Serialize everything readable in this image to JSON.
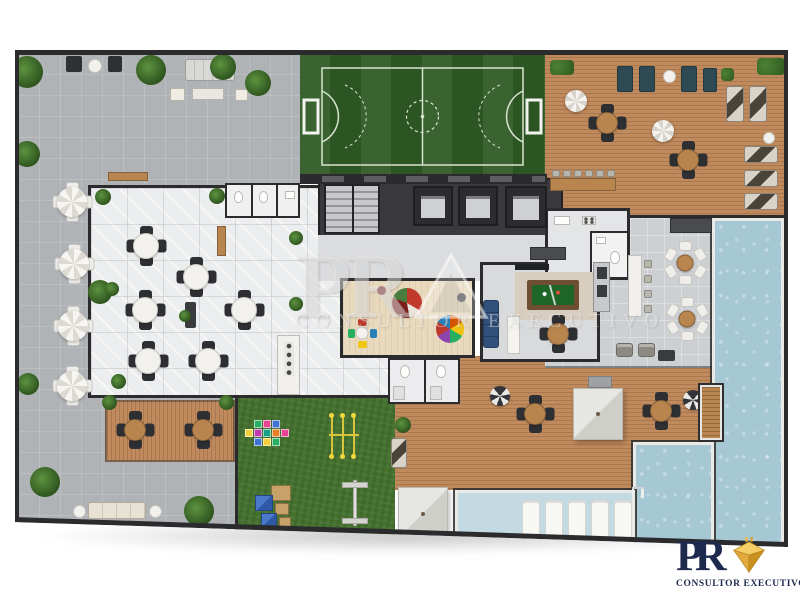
{
  "watermark": {
    "initials": "PR",
    "tagline": "CONSULTOR EXECUTIVO"
  },
  "brand": {
    "initials": "PR",
    "tagline": "CONSULTOR EXECUTIVO"
  },
  "palette": {
    "wall": "#2b2b2d",
    "terrace": "#b0b3b6",
    "hallFloor": "#ecedee",
    "poolsideTile": "#cdd0d2",
    "wood": "#c18a5c",
    "lawn": "#45722f",
    "field": "#2f5b26",
    "fieldLine": "#d8e4d0",
    "water": "#a6c7d4",
    "waterLight": "#c3dae2",
    "coping": "#e9e9e6",
    "corridor": "#dbdcde",
    "core": "#3a3a3c",
    "kidsFloor": "#e9d9bd",
    "gameFloor": "#d9dadb",
    "rug": "#d8cec0",
    "felt": "#1e652a",
    "sofaBlue": "#31517c",
    "furnWood": "#b9854f",
    "navy": "#1d2a4e",
    "gold": "#eab944"
  },
  "areas": [
    {
      "id": "paved-terrace",
      "color": "#b0b3b6"
    },
    {
      "id": "soccer-field",
      "color": "#2f5b26"
    },
    {
      "id": "wood-deck-lounge",
      "color": "#c18a5c"
    },
    {
      "id": "pool",
      "color": "#a6c7d4"
    },
    {
      "id": "party-hall",
      "color": "#ecedee"
    },
    {
      "id": "building-core-stairs-elevators",
      "color": "#3a3a3c"
    },
    {
      "id": "kids-playroom",
      "color": "#e9d9bd"
    },
    {
      "id": "game-room-billiards",
      "color": "#d9dadb"
    },
    {
      "id": "gourmet-kitchen",
      "color": "#e4e5e6"
    },
    {
      "id": "playground-lawn",
      "color": "#45722f"
    }
  ],
  "furniture": {
    "items": [
      {
        "k": "bench-dark",
        "x": 51,
        "y": 6,
        "w": 16,
        "h": 16
      },
      {
        "k": "round-white",
        "x": 73,
        "y": 9,
        "w": 14,
        "h": 14
      },
      {
        "k": "bench-dark",
        "x": 93,
        "y": 6,
        "w": 14,
        "h": 16
      },
      {
        "k": "sofa-set",
        "x": 170,
        "y": 9,
        "w": 50,
        "h": 22
      },
      {
        "k": "ottoman",
        "x": 155,
        "y": 38,
        "w": 15,
        "h": 13
      },
      {
        "k": "coffee-table",
        "x": 177,
        "y": 38,
        "w": 32,
        "h": 12
      },
      {
        "k": "ottoman",
        "x": 220,
        "y": 39,
        "w": 13,
        "h": 12
      },
      {
        "k": "console-wood",
        "x": 93,
        "y": 122,
        "w": 40,
        "h": 9
      },
      {
        "k": "umb-table",
        "cx": 57,
        "cy": 152
      },
      {
        "k": "umb-table",
        "cx": 59,
        "cy": 214
      },
      {
        "k": "umb-table",
        "cx": 58,
        "cy": 276
      },
      {
        "k": "umb-table",
        "cx": 57,
        "cy": 336
      },
      {
        "k": "sofa-cream",
        "x": 73,
        "y": 452,
        "w": 58,
        "h": 17
      },
      {
        "k": "round-white",
        "x": 58,
        "y": 455,
        "w": 13,
        "h": 13
      },
      {
        "k": "round-white",
        "x": 134,
        "y": 455,
        "w": 13,
        "h": 13
      },
      {
        "k": "table4wood",
        "cx": 120,
        "cy": 380
      },
      {
        "k": "table4wood",
        "cx": 188,
        "cy": 380
      },
      {
        "k": "table4",
        "cx": 131,
        "cy": 196
      },
      {
        "k": "table4",
        "cx": 181,
        "cy": 227
      },
      {
        "k": "table4",
        "cx": 130,
        "cy": 260
      },
      {
        "k": "table4",
        "cx": 229,
        "cy": 260
      },
      {
        "k": "table4",
        "cx": 133,
        "cy": 311
      },
      {
        "k": "table4",
        "cx": 193,
        "cy": 311
      },
      {
        "k": "buffet-dark",
        "x": 170,
        "y": 252,
        "w": 11,
        "h": 26
      },
      {
        "k": "bar-wood",
        "x": 202,
        "y": 176,
        "w": 9,
        "h": 30
      },
      {
        "k": "hedge",
        "x": 535,
        "y": 10,
        "w": 24,
        "h": 15
      },
      {
        "k": "hedge",
        "x": 742,
        "y": 8,
        "w": 28,
        "h": 17
      },
      {
        "k": "bench-teal",
        "x": 602,
        "y": 16,
        "w": 16,
        "h": 26
      },
      {
        "k": "bench-teal",
        "x": 624,
        "y": 16,
        "w": 16,
        "h": 26
      },
      {
        "k": "round-white",
        "x": 648,
        "y": 20,
        "w": 13,
        "h": 13
      },
      {
        "k": "bench-teal",
        "x": 666,
        "y": 16,
        "w": 16,
        "h": 26
      },
      {
        "k": "bench-teal",
        "x": 688,
        "y": 18,
        "w": 14,
        "h": 24
      },
      {
        "k": "hedge",
        "x": 706,
        "y": 18,
        "w": 13,
        "h": 13
      },
      {
        "k": "umb",
        "cx": 561,
        "cy": 51
      },
      {
        "k": "table4wood",
        "cx": 592,
        "cy": 73
      },
      {
        "k": "umb",
        "cx": 648,
        "cy": 81
      },
      {
        "k": "table4wood",
        "cx": 673,
        "cy": 110
      },
      {
        "k": "lounger-v",
        "x": 711,
        "y": 36,
        "w": 18,
        "h": 36
      },
      {
        "k": "lounger-v",
        "x": 734,
        "y": 36,
        "w": 18,
        "h": 36
      },
      {
        "k": "round-white",
        "x": 748,
        "y": 82,
        "w": 12,
        "h": 12
      },
      {
        "k": "lounger-h",
        "x": 729,
        "y": 96,
        "w": 34,
        "h": 17
      },
      {
        "k": "lounger-h",
        "x": 729,
        "y": 120,
        "w": 34,
        "h": 17
      },
      {
        "k": "lounger-h",
        "x": 729,
        "y": 143,
        "w": 34,
        "h": 17
      },
      {
        "k": "counter-wood",
        "x": 535,
        "y": 128,
        "w": 66,
        "h": 13
      },
      {
        "k": "stool",
        "x": 537,
        "y": 120,
        "w": 8,
        "h": 7
      },
      {
        "k": "stool",
        "x": 548,
        "y": 120,
        "w": 8,
        "h": 7
      },
      {
        "k": "stool",
        "x": 559,
        "y": 120,
        "w": 8,
        "h": 7
      },
      {
        "k": "stool",
        "x": 570,
        "y": 120,
        "w": 8,
        "h": 7
      },
      {
        "k": "stool",
        "x": 581,
        "y": 120,
        "w": 8,
        "h": 7
      },
      {
        "k": "stool",
        "x": 592,
        "y": 120,
        "w": 8,
        "h": 7
      },
      {
        "k": "counter-white",
        "x": 613,
        "y": 205,
        "w": 14,
        "h": 62
      },
      {
        "k": "stool",
        "x": 629,
        "y": 210,
        "w": 8,
        "h": 8
      },
      {
        "k": "stool",
        "x": 629,
        "y": 225,
        "w": 8,
        "h": 8
      },
      {
        "k": "stool",
        "x": 629,
        "y": 240,
        "w": 8,
        "h": 8
      },
      {
        "k": "stool",
        "x": 629,
        "y": 255,
        "w": 8,
        "h": 8
      },
      {
        "k": "table6",
        "cx": 670,
        "cy": 213
      },
      {
        "k": "table6",
        "cx": 672,
        "cy": 269
      },
      {
        "k": "armchair",
        "x": 601,
        "y": 293,
        "w": 17,
        "h": 14
      },
      {
        "k": "armchair",
        "x": 623,
        "y": 293,
        "w": 17,
        "h": 14
      },
      {
        "k": "table-dark",
        "x": 643,
        "y": 300,
        "w": 17,
        "h": 11
      },
      {
        "k": "counter-dark",
        "x": 655,
        "y": 168,
        "w": 42,
        "h": 15
      },
      {
        "k": "counter-dark",
        "x": 515,
        "y": 197,
        "w": 36,
        "h": 13
      },
      {
        "k": "folded-umb",
        "cx": 485,
        "cy": 346
      },
      {
        "k": "folded-umb",
        "cx": 678,
        "cy": 350
      },
      {
        "k": "table4wood",
        "cx": 520,
        "cy": 364
      },
      {
        "k": "table4wood",
        "cx": 646,
        "cy": 361
      },
      {
        "k": "gray-table",
        "x": 573,
        "y": 326,
        "w": 24,
        "h": 12
      },
      {
        "k": "lounger-v",
        "x": 376,
        "y": 388,
        "w": 16,
        "h": 30
      },
      {
        "k": "plant",
        "cx": 388,
        "cy": 375,
        "s": 16
      },
      {
        "k": "table4wood",
        "cx": 543,
        "cy": 284
      },
      {
        "k": "pool-lounger",
        "x": 507,
        "y": 450,
        "w": 18,
        "h": 42
      },
      {
        "k": "pool-lounger",
        "x": 530,
        "y": 450,
        "w": 18,
        "h": 42
      },
      {
        "k": "pool-lounger",
        "x": 553,
        "y": 450,
        "w": 18,
        "h": 42
      },
      {
        "k": "pool-lounger",
        "x": 576,
        "y": 450,
        "w": 18,
        "h": 42
      },
      {
        "k": "pool-lounger",
        "x": 599,
        "y": 450,
        "w": 18,
        "h": 42
      },
      {
        "k": "plant",
        "cx": 12,
        "cy": 22,
        "s": 32
      },
      {
        "k": "plant",
        "cx": 136,
        "cy": 20,
        "s": 30
      },
      {
        "k": "plant",
        "cx": 208,
        "cy": 17,
        "s": 26
      },
      {
        "k": "plant",
        "cx": 243,
        "cy": 33,
        "s": 26
      },
      {
        "k": "plant",
        "cx": 12,
        "cy": 104,
        "s": 26
      },
      {
        "k": "plant",
        "cx": 85,
        "cy": 242,
        "s": 24
      },
      {
        "k": "plant",
        "cx": 13,
        "cy": 334,
        "s": 22
      },
      {
        "k": "plant",
        "cx": 30,
        "cy": 432,
        "s": 30
      },
      {
        "k": "plant",
        "cx": 184,
        "cy": 461,
        "s": 30
      },
      {
        "k": "plant",
        "cx": 94,
        "cy": 352,
        "s": 15
      },
      {
        "k": "plant",
        "cx": 211,
        "cy": 352,
        "s": 15
      },
      {
        "k": "plant",
        "cx": 88,
        "cy": 147,
        "s": 16
      },
      {
        "k": "plant",
        "cx": 202,
        "cy": 146,
        "s": 16
      },
      {
        "k": "plant",
        "cx": 97,
        "cy": 239,
        "s": 14
      },
      {
        "k": "plant",
        "cx": 170,
        "cy": 266,
        "s": 12
      },
      {
        "k": "plant",
        "cx": 103,
        "cy": 331,
        "s": 15
      },
      {
        "k": "plant",
        "cx": 281,
        "cy": 188,
        "s": 14
      },
      {
        "k": "plant",
        "cx": 281,
        "cy": 254,
        "s": 14
      }
    ]
  },
  "playground": {
    "hopscotch_origin": {
      "x": 228,
      "y": 370
    },
    "hopscotch": [
      {
        "dx": 11,
        "dy": 0,
        "c": "#27ae60"
      },
      {
        "dx": 20,
        "dy": 0,
        "c": "#e84393"
      },
      {
        "dx": 29,
        "dy": 0,
        "c": "#3f72d6"
      },
      {
        "dx": 2,
        "dy": 9,
        "c": "#f4d03f"
      },
      {
        "dx": 11,
        "dy": 9,
        "c": "#c03ab0"
      },
      {
        "dx": 20,
        "dy": 9,
        "c": "#16a085"
      },
      {
        "dx": 29,
        "dy": 9,
        "c": "#e67e22"
      },
      {
        "dx": 38,
        "dy": 9,
        "c": "#e84393"
      },
      {
        "dx": 11,
        "dy": 18,
        "c": "#3f72d6"
      },
      {
        "dx": 20,
        "dy": 18,
        "c": "#f4d03f"
      },
      {
        "dx": 29,
        "dy": 18,
        "c": "#27ae60"
      }
    ]
  }
}
